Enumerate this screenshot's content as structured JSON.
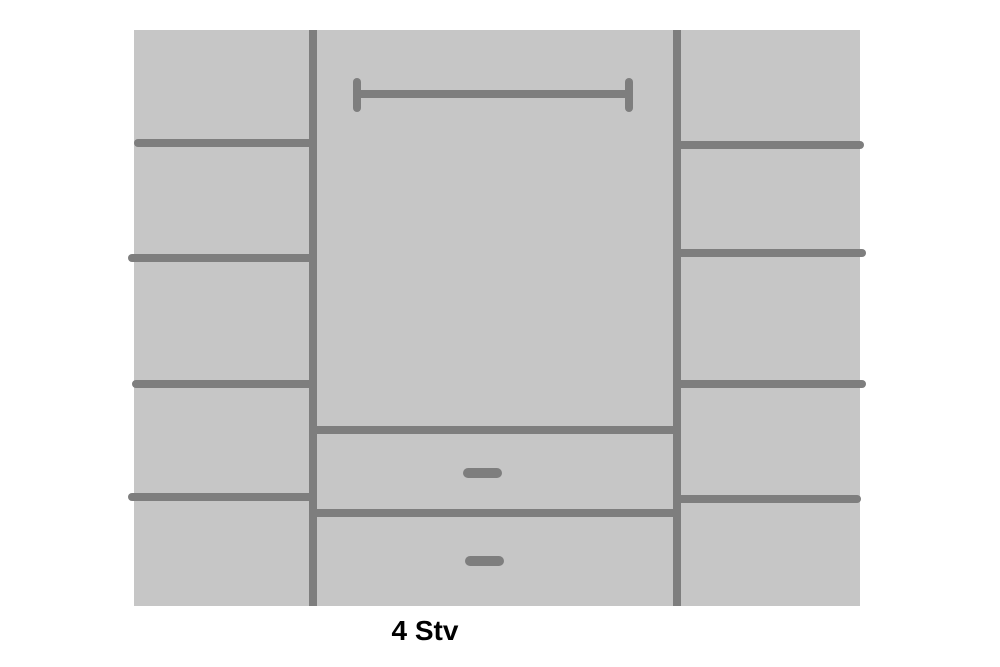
{
  "diagram": {
    "label": "4 Stv",
    "description": "Wardrobe interior layout schematic: left and right columns each divided by four shelves into five compartments; centre section with a clothes hanging rail on top and two drawers with handles at the bottom",
    "colors": {
      "page_background": "#ffffff",
      "cabinet_fill": "#c6c6c6",
      "line": "#7e7e7e",
      "label_text": "#000000"
    },
    "left_column": {
      "shelf_lines": 4,
      "compartments": 5
    },
    "middle_column": {
      "hanging_rail": 1,
      "drawers": 2,
      "drawer_handles": 2
    },
    "right_column": {
      "shelf_lines": 4,
      "compartments": 5
    }
  }
}
